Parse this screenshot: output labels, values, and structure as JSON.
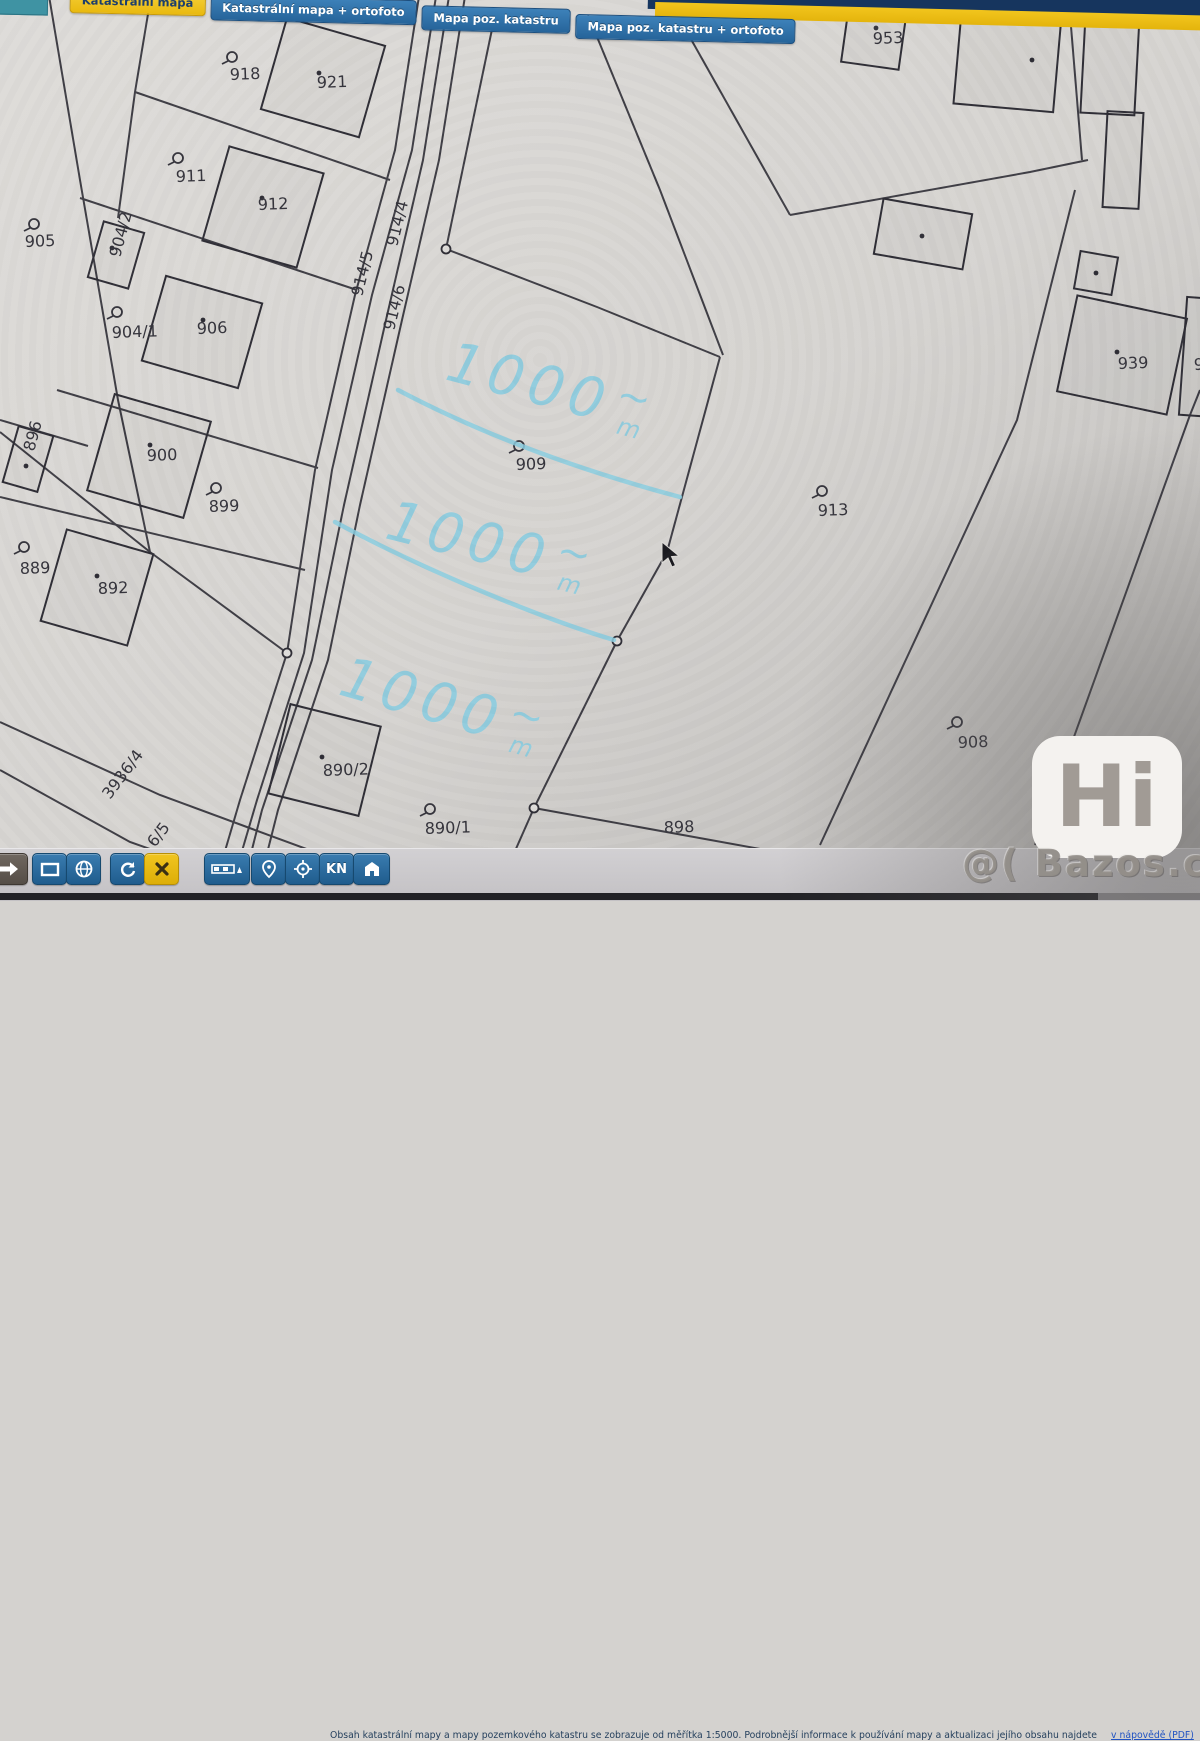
{
  "tabs": [
    {
      "label": "Katastrální mapa",
      "active": true
    },
    {
      "label": "Katastrální mapa + ortofoto",
      "active": false
    },
    {
      "label": "Mapa poz. katastru",
      "active": false
    },
    {
      "label": "Mapa poz. katastru + ortofoto",
      "active": false
    }
  ],
  "toolbar": {
    "buttons": [
      "pan-arrow",
      "extent-rectangle",
      "globe",
      "refresh",
      "close",
      "scale-bar",
      "place-pin",
      "crosshair",
      "kn",
      "home-flag"
    ],
    "kn_label": "KN"
  },
  "footer": {
    "disclaimer": "Obsah katastrální mapy a mapy pozemkového katastru se zobrazuje od měřítka 1:5000. Podrobnější informace k používání mapy a aktualizaci jejího obsahu najdete",
    "link": "v nápovědě (PDF)",
    "warning": "Veškeré zadávané hodnoty souřadnic a délek …"
  },
  "watermark": {
    "logo": "Hi",
    "site": "@( Bazos.cz"
  },
  "map": {
    "colors": {
      "paper1": "#dedcd9",
      "paper2": "#d6d4d1",
      "paper3": "#bab8b6",
      "line": "#2f2e36",
      "label": "#35343c",
      "annotation": "#8accdf"
    },
    "parcel_labels": [
      {
        "t": "918",
        "x": 230,
        "y": 80,
        "sym": [
          232,
          57
        ]
      },
      {
        "t": "921",
        "x": 317,
        "y": 88
      },
      {
        "t": "911",
        "x": 176,
        "y": 182,
        "sym": [
          178,
          158
        ]
      },
      {
        "t": "912",
        "x": 258,
        "y": 210
      },
      {
        "t": "905",
        "x": 25,
        "y": 247,
        "sym": [
          34,
          224
        ]
      },
      {
        "t": "904/2",
        "x": 120,
        "y": 258,
        "rot": -75
      },
      {
        "t": "904/1",
        "x": 112,
        "y": 338,
        "sym": [
          117,
          312
        ]
      },
      {
        "t": "906",
        "x": 197,
        "y": 334
      },
      {
        "t": "896",
        "x": 34,
        "y": 452,
        "rot": -75
      },
      {
        "t": "900",
        "x": 147,
        "y": 461
      },
      {
        "t": "899",
        "x": 209,
        "y": 512,
        "sym": [
          216,
          488
        ]
      },
      {
        "t": "889",
        "x": 20,
        "y": 574,
        "sym": [
          24,
          547
        ]
      },
      {
        "t": "892",
        "x": 98,
        "y": 594
      },
      {
        "t": "914/5",
        "x": 362,
        "y": 297,
        "rot": -76
      },
      {
        "t": "914/4",
        "x": 397,
        "y": 247,
        "rot": -76
      },
      {
        "t": "914/6",
        "x": 394,
        "y": 331,
        "rot": -76
      },
      {
        "t": "909",
        "x": 516,
        "y": 470,
        "sym": [
          519,
          446
        ]
      },
      {
        "t": "913",
        "x": 818,
        "y": 516,
        "sym": [
          822,
          491
        ]
      },
      {
        "t": "953",
        "x": 873,
        "y": 44,
        "dot": [
          876,
          28
        ]
      },
      {
        "t": "939",
        "x": 1118,
        "y": 369
      },
      {
        "t": "94",
        "x": 1194,
        "y": 370
      },
      {
        "t": "908",
        "x": 958,
        "y": 748,
        "sym": [
          957,
          722
        ]
      },
      {
        "t": "898",
        "x": 664,
        "y": 833
      },
      {
        "t": "890/1",
        "x": 425,
        "y": 834,
        "sym": [
          430,
          809
        ]
      },
      {
        "t": "890/2",
        "x": 323,
        "y": 776
      },
      {
        "t": "3936/4",
        "x": 110,
        "y": 800,
        "rot": -53
      },
      {
        "t": "6/5",
        "x": 155,
        "y": 848,
        "rot": -53
      }
    ],
    "lines": [
      [
        [
          420,
          -10
        ],
        [
          395,
          150
        ],
        [
          355,
          295
        ],
        [
          315,
          470
        ],
        [
          287,
          653
        ],
        [
          240,
          800
        ],
        [
          215,
          885
        ]
      ],
      [
        [
          437,
          -10
        ],
        [
          412,
          150
        ],
        [
          372,
          295
        ],
        [
          332,
          470
        ],
        [
          304,
          653
        ],
        [
          257,
          800
        ],
        [
          232,
          885
        ]
      ],
      [
        [
          450,
          -10
        ],
        [
          423,
          160
        ],
        [
          386,
          320
        ],
        [
          344,
          505
        ],
        [
          312,
          660
        ],
        [
          262,
          810
        ],
        [
          243,
          885
        ]
      ],
      [
        [
          466,
          -10
        ],
        [
          439,
          160
        ],
        [
          402,
          320
        ],
        [
          360,
          505
        ],
        [
          328,
          660
        ],
        [
          278,
          810
        ],
        [
          259,
          885
        ]
      ],
      [
        [
          48,
          -10
        ],
        [
          80,
          180
        ],
        [
          118,
          400
        ],
        [
          150,
          552
        ]
      ],
      [
        [
          152,
          -10
        ],
        [
          135,
          92
        ],
        [
          118,
          218
        ]
      ],
      [
        [
          135,
          92
        ],
        [
          390,
          180
        ]
      ],
      [
        [
          80,
          198
        ],
        [
          357,
          290
        ]
      ],
      [
        [
          57,
          390
        ],
        [
          318,
          468
        ]
      ],
      [
        [
          0,
          497
        ],
        [
          305,
          570
        ]
      ],
      [
        [
          0,
          432
        ],
        [
          150,
          552
        ],
        [
          287,
          653
        ]
      ],
      [
        [
          0,
          420
        ],
        [
          88,
          446
        ]
      ],
      [
        [
          0,
          722
        ],
        [
          160,
          795
        ],
        [
          350,
          865
        ],
        [
          430,
          895
        ]
      ],
      [
        [
          0,
          770
        ],
        [
          130,
          842
        ],
        [
          280,
          895
        ]
      ],
      [
        [
          495,
          15
        ],
        [
          446,
          249
        ],
        [
          597,
          307
        ],
        [
          720,
          357
        ]
      ],
      [
        [
          588,
          15
        ],
        [
          660,
          190
        ],
        [
          723,
          355
        ]
      ],
      [
        [
          720,
          357
        ],
        [
          667,
          552
        ],
        [
          617,
          641
        ],
        [
          534,
          808
        ],
        [
          500,
          885
        ]
      ],
      [
        [
          534,
          808
        ],
        [
          810,
          858
        ]
      ],
      [
        [
          683,
          25
        ],
        [
          790,
          215
        ]
      ],
      [
        [
          790,
          215
        ],
        [
          1030,
          172
        ],
        [
          1088,
          160
        ]
      ],
      [
        [
          1075,
          190
        ],
        [
          1017,
          420
        ],
        [
          820,
          845
        ]
      ],
      [
        [
          1200,
          390
        ],
        [
          1190,
          415
        ],
        [
          1035,
          845
        ]
      ],
      [
        [
          1068,
          -10
        ],
        [
          1082,
          160
        ]
      ]
    ],
    "buildings": [
      {
        "x": 272,
        "y": 30,
        "w": 102,
        "h": 95,
        "rot": 16,
        "dot": [
          319,
          73
        ]
      },
      {
        "x": 214,
        "y": 158,
        "w": 98,
        "h": 98,
        "rot": 16,
        "dot": [
          262,
          198
        ]
      },
      {
        "x": 95,
        "y": 226,
        "w": 42,
        "h": 58,
        "rot": 16,
        "dot": [
          112,
          248
        ]
      },
      {
        "x": 152,
        "y": 288,
        "w": 100,
        "h": 88,
        "rot": 16,
        "dot": [
          203,
          320
        ]
      },
      {
        "x": 10,
        "y": 430,
        "w": 36,
        "h": 58,
        "rot": 16,
        "dot": [
          26,
          466
        ]
      },
      {
        "x": 99,
        "y": 406,
        "w": 100,
        "h": 100,
        "rot": 16,
        "dot": [
          150,
          445
        ]
      },
      {
        "x": 52,
        "y": 540,
        "w": 90,
        "h": 95,
        "rot": 16,
        "dot": [
          97,
          576
        ]
      },
      {
        "x": 278,
        "y": 714,
        "w": 93,
        "h": 92,
        "rot": 14,
        "dot": [
          322,
          757
        ]
      },
      {
        "x": 958,
        "y": 0,
        "w": 100,
        "h": 108,
        "rot": 5,
        "dot": [
          1032,
          60
        ]
      },
      {
        "x": 845,
        "y": 6,
        "w": 58,
        "h": 60,
        "rot": 8
      },
      {
        "x": 878,
        "y": 206,
        "w": 90,
        "h": 56,
        "rot": 10,
        "dot": [
          922,
          236
        ]
      },
      {
        "x": 1083,
        "y": 14,
        "w": 54,
        "h": 100,
        "rot": 3
      },
      {
        "x": 1105,
        "y": 112,
        "w": 36,
        "h": 96,
        "rot": 3
      },
      {
        "x": 1077,
        "y": 254,
        "w": 38,
        "h": 38,
        "rot": 10,
        "dot": [
          1096,
          273
        ]
      },
      {
        "x": 1066,
        "y": 306,
        "w": 112,
        "h": 98,
        "rot": 12,
        "dot": [
          1117,
          352
        ]
      },
      {
        "x": 1183,
        "y": 298,
        "w": 34,
        "h": 118,
        "rot": 4
      }
    ],
    "nodes": [
      [
        446,
        249
      ],
      [
        617,
        641
      ],
      [
        534,
        808
      ],
      [
        287,
        653
      ]
    ],
    "annotations": {
      "area_label": "1000 m²",
      "texts": [
        {
          "x": 555,
          "y": 388,
          "rot": 15
        },
        {
          "x": 495,
          "y": 545,
          "rot": 14
        },
        {
          "x": 448,
          "y": 705,
          "rot": 16
        }
      ],
      "curves": [
        "M398,390 C470,428 560,465 680,497",
        "M335,522 C420,568 540,618 614,640"
      ]
    },
    "cursor": {
      "x": 662,
      "y": 542
    }
  }
}
